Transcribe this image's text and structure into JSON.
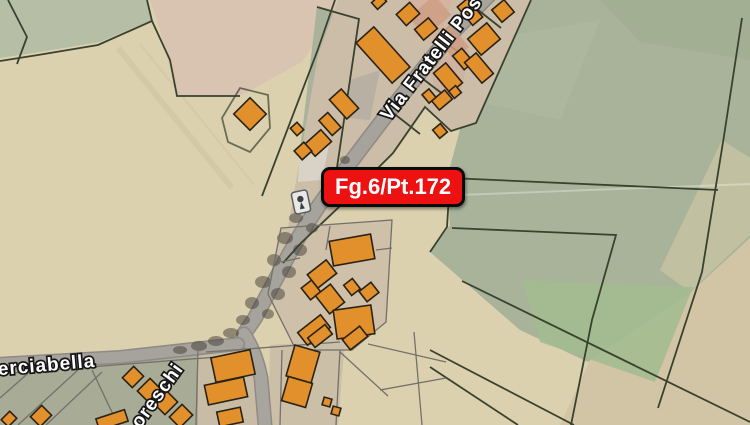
{
  "map": {
    "parcel_badge": {
      "label": "Fg.6/Pt.172",
      "bg_color": "#ee1111",
      "border_color": "#0a0a0a",
      "text_color": "#ffffff"
    },
    "streets": {
      "fratelli": {
        "label": "Via Fratelli Pos"
      },
      "merciabella": {
        "label": "erciabella"
      },
      "moreschi": {
        "label": "oreschi"
      }
    },
    "icons": {
      "marker": "street-marker-icon"
    },
    "colors": {
      "field_tan": "#dcd1ae",
      "field_sage": "#b6bfa6",
      "field_pink": "#d8c2b2",
      "field_green": "#a8b39a",
      "built_strip": "#cbbda7",
      "yard_green": "#a8ab96",
      "road_gray": "#a6a29c",
      "building_orange": "#e2902c",
      "building_outline": "#2a2214",
      "parcel_line_dark": "#39422f",
      "parcel_line_gray": "#74706a"
    }
  }
}
